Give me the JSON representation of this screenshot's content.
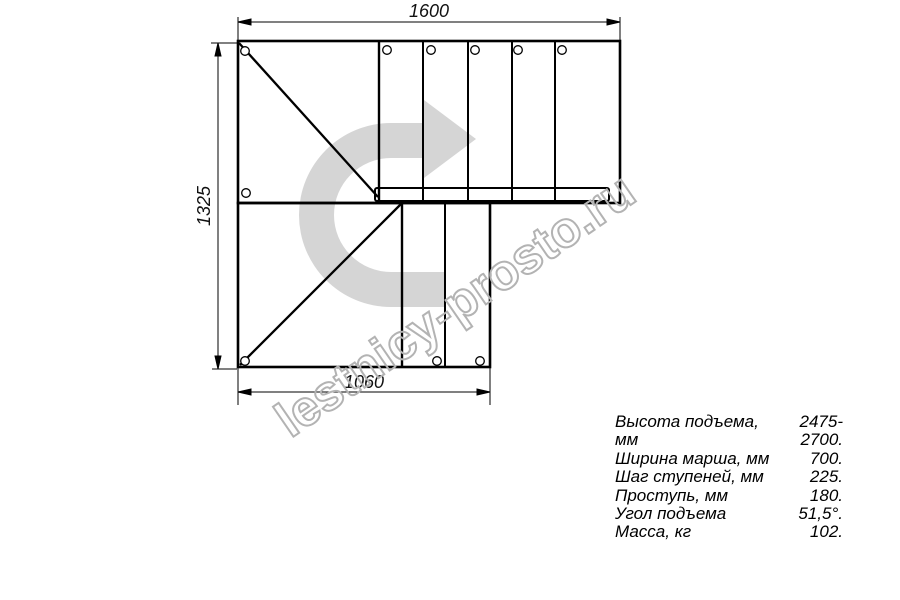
{
  "drawing": {
    "type": "stair-plan-top-view",
    "line_color": "#000000",
    "arrow_color": "#d5d5d5",
    "dimensions": {
      "top_width": "1600",
      "left_height": "1325",
      "bottom_width": "1060"
    }
  },
  "watermark": {
    "text": "lestnicy-prosto.ru",
    "stroke_color": "#b3b3b3"
  },
  "specs": {
    "rows": [
      {
        "label": "Высота подъема, мм",
        "value": "2475-2700."
      },
      {
        "label": "Ширина марша, мм",
        "value": "700."
      },
      {
        "label": "Шаг ступеней, мм",
        "value": "225."
      },
      {
        "label": "Проступь, мм",
        "value": "180."
      },
      {
        "label": "Угол подъема",
        "value": "51,5°."
      },
      {
        "label": "Масса, кг",
        "value": "102."
      }
    ]
  }
}
